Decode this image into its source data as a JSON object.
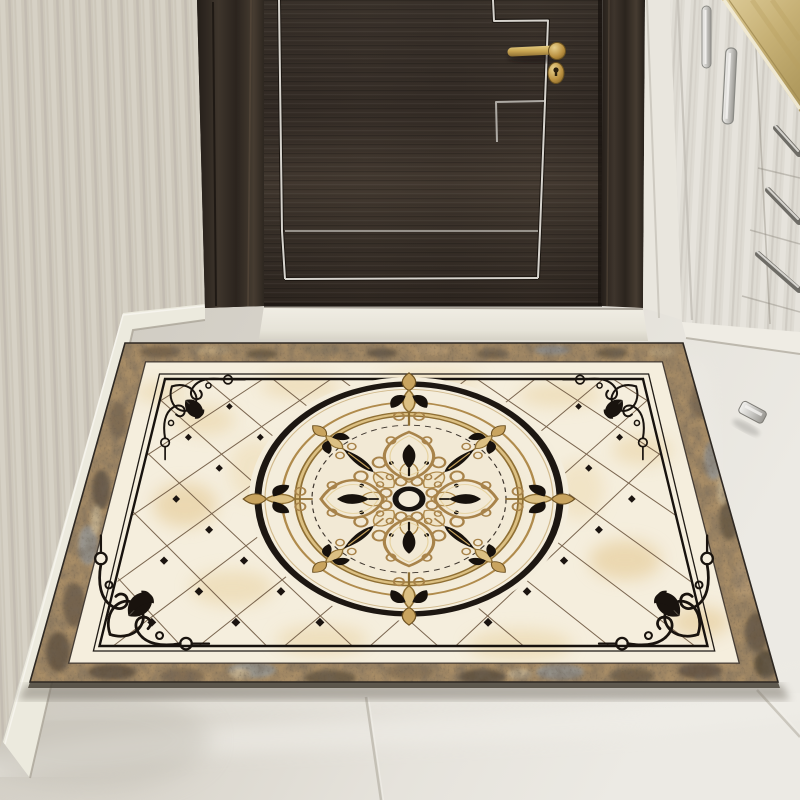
{
  "image": {
    "type": "photo",
    "subject": "Entryway interior: ornate beige marble-pattern floor mat with round baroque medallion lying on gray marble tile in front of a dark wooden door",
    "width": 800,
    "height": 800
  },
  "objects": {
    "door": "dark espresso wood entry door with thin silver inlay lines",
    "door_handle": "brass lever handle with round rosette and oval keyhole escutcheon",
    "door_casing": "dark wood door frame",
    "threshold": "white stone door sill",
    "left_wall": "cream striped wallpaper with white baseboard",
    "right_cabinets": "white cabinets and drawers with metal bar handles",
    "gold_panel": "golden wood panel in upper right corner",
    "door_stop": "small metal door stop on the floor right of the mat",
    "floor": "light warm-gray marble tile with faint seams",
    "rug": "rectangular mat: brown marble border, black corner scrollwork frame, cream onyx field with diamond lattice and dots, central circular medallion with gold scrolls, black leaves and fleur-de-lis"
  },
  "colors": {
    "door": "#372f28",
    "casing": "#2b241e",
    "door-inlay": "#d6d3cd",
    "brass": "#c9a553",
    "wall": "#cdc7ba",
    "baseboard": "#eceade",
    "cabinet": "#dedbd3",
    "gold-panel": "#c9b377",
    "floor": "#dcd8d0",
    "rug-field": "#f5eedd",
    "rug-gold": "#c9a45f",
    "rug-black": "#17110c",
    "rug-border": "#9c8261"
  },
  "rug_geometry": {
    "outer_corners": [
      [
        125,
        343
      ],
      [
        683,
        343
      ],
      [
        778,
        682
      ],
      [
        30,
        682
      ]
    ],
    "medallion_center": [
      409,
      499
    ],
    "medallion_radius_x": 155,
    "medallion_radius_y": 118
  }
}
